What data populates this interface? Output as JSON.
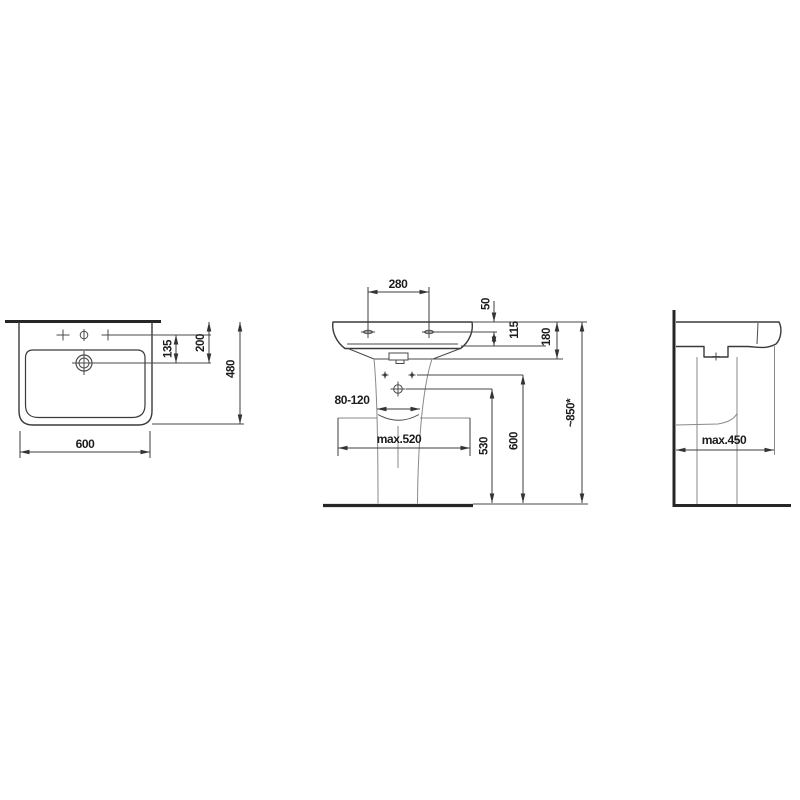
{
  "top_view": {
    "dim_600": "600",
    "dim_480": "480",
    "dim_200": "200",
    "dim_135": "135"
  },
  "front_view": {
    "dim_280": "280",
    "dim_50": "50",
    "dim_115": "115",
    "dim_180": "180",
    "dim_80_120": "80-120",
    "dim_max520": "max.520",
    "dim_530": "530",
    "dim_600": "600",
    "dim_850": "~850*"
  },
  "side_view": {
    "dim_max450": "max.450"
  }
}
